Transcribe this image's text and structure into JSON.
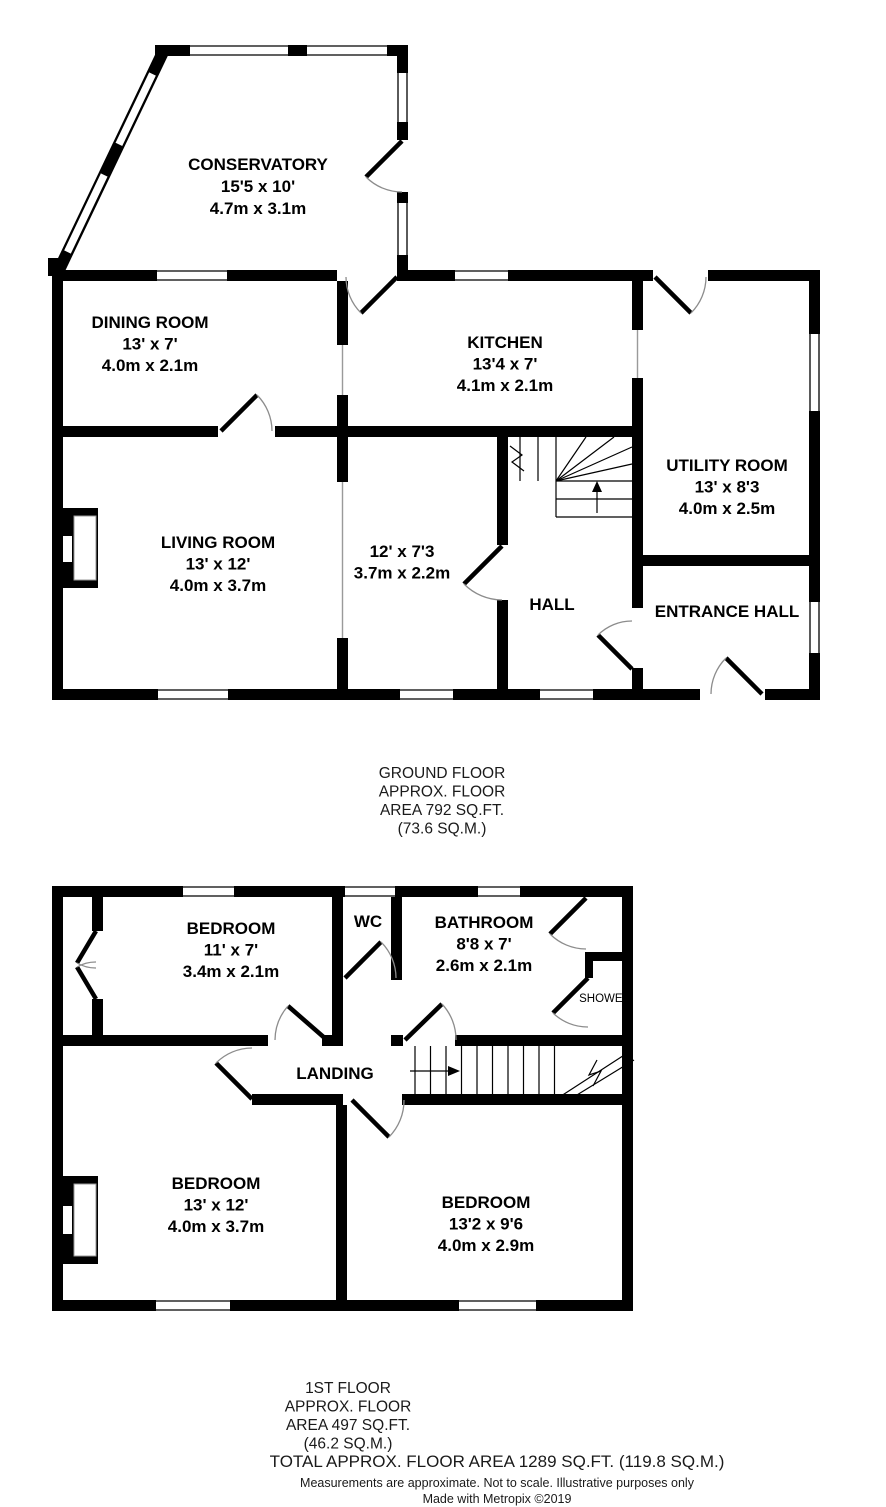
{
  "ground_floor": {
    "rooms": {
      "conservatory": {
        "name": "CONSERVATORY",
        "dims_ft": "15'5 x 10'",
        "dims_m": "4.7m x 3.1m"
      },
      "dining": {
        "name": "DINING ROOM",
        "dims_ft": "13' x 7'",
        "dims_m": "4.0m x 2.1m"
      },
      "kitchen": {
        "name": "KITCHEN",
        "dims_ft": "13'4 x 7'",
        "dims_m": "4.1m x 2.1m"
      },
      "utility": {
        "name": "UTILITY ROOM",
        "dims_ft": "13' x 8'3",
        "dims_m": "4.0m x 2.5m"
      },
      "living": {
        "name": "LIVING ROOM",
        "dims_ft": "13' x 12'",
        "dims_m": "4.0m x 3.7m"
      },
      "inner_room": {
        "name": "",
        "dims_ft": "12' x 7'3",
        "dims_m": "3.7m x 2.2m"
      },
      "hall": {
        "name": "HALL"
      },
      "entrance": {
        "name": "ENTRANCE HALL"
      }
    },
    "caption": [
      "GROUND FLOOR",
      "APPROX. FLOOR",
      "AREA 792 SQ.FT.",
      "(73.6 SQ.M.)"
    ]
  },
  "first_floor": {
    "rooms": {
      "bedroom1": {
        "name": "BEDROOM",
        "dims_ft": "11' x 7'",
        "dims_m": "3.4m x 2.1m"
      },
      "wc": {
        "name": "WC"
      },
      "bathroom": {
        "name": "BATHROOM",
        "dims_ft": "8'8 x 7'",
        "dims_m": "2.6m x 2.1m"
      },
      "shower": {
        "name": "SHOWER"
      },
      "landing": {
        "name": "LANDING"
      },
      "bedroom2": {
        "name": "BEDROOM",
        "dims_ft": "13' x 12'",
        "dims_m": "4.0m x 3.7m"
      },
      "bedroom3": {
        "name": "BEDROOM",
        "dims_ft": "13'2 x 9'6",
        "dims_m": "4.0m x 2.9m"
      }
    },
    "caption": [
      "1ST FLOOR",
      "APPROX. FLOOR",
      "AREA 497 SQ.FT.",
      "(46.2 SQ.M.)"
    ]
  },
  "footer": {
    "total": "TOTAL APPROX. FLOOR AREA 1289 SQ.FT. (119.8 SQ.M.)",
    "disclaimer": "Measurements are approximate.  Not to scale.  Illustrative purposes only",
    "credit": "Made with Metropix ©2019"
  },
  "colors": {
    "wall": "#000000",
    "door_arc": "#8c8c8c",
    "text": "#000000",
    "caption_text": "#1a1a1a"
  }
}
